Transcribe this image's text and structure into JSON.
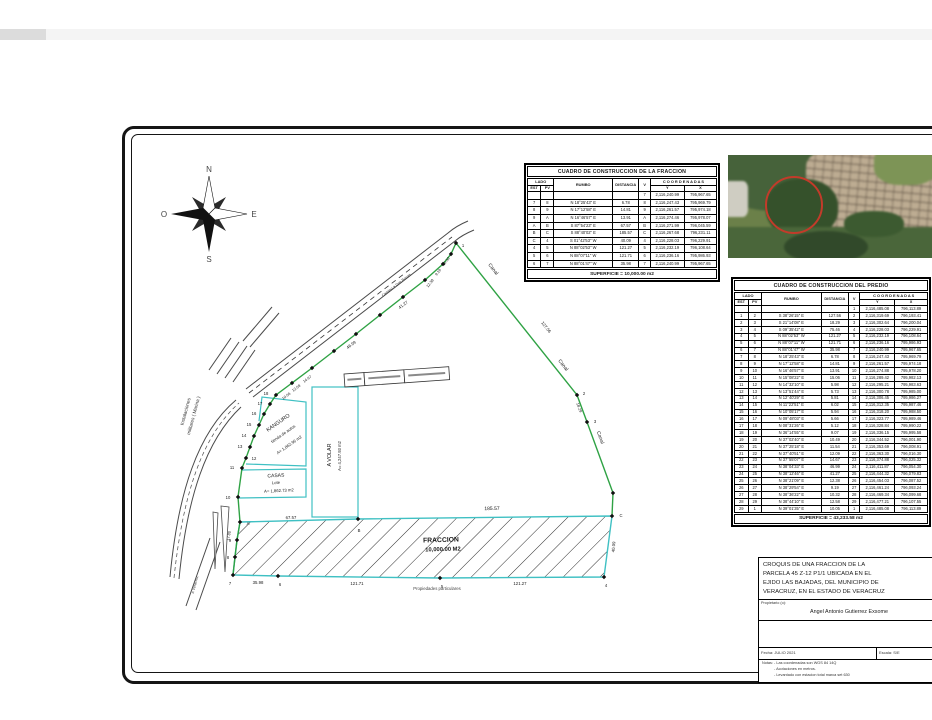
{
  "compass": {
    "n": "N",
    "s": "S",
    "e": "E",
    "o": "O"
  },
  "drawing": {
    "labels": [
      {
        "t": "Canal",
        "x": 492,
        "y": 270,
        "r": 52,
        "s": 5,
        "c": "#222",
        "n": "canal-label"
      },
      {
        "t": "Canal",
        "x": 562,
        "y": 366,
        "r": 52,
        "s": 5,
        "c": "#222",
        "n": "canal-label"
      },
      {
        "t": "Canal",
        "x": 599,
        "y": 438,
        "r": 70,
        "s": 5,
        "c": "#222",
        "n": "canal-label"
      },
      {
        "t": "127.56",
        "x": 545,
        "y": 328,
        "r": 52,
        "s": 4.3,
        "n": "distance-label"
      },
      {
        "t": "18.29",
        "x": 578,
        "y": 408,
        "r": 70,
        "s": 4,
        "n": "distance-label"
      },
      {
        "t": "41.27",
        "x": 404,
        "y": 306,
        "r": -37,
        "s": 4.3,
        "n": "distance-label"
      },
      {
        "t": "46.99",
        "x": 352,
        "y": 346,
        "r": -37,
        "s": 4.3,
        "n": "distance-label"
      },
      {
        "t": "14.67",
        "x": 308,
        "y": 380,
        "r": -37,
        "s": 3.8,
        "n": "distance-label"
      },
      {
        "t": "12.09",
        "x": 297,
        "y": 389,
        "r": -37,
        "s": 3.8,
        "n": "distance-label"
      },
      {
        "t": "10.06",
        "x": 287,
        "y": 397,
        "r": -37,
        "s": 3.8,
        "n": "distance-label"
      },
      {
        "t": "12.38",
        "x": 431,
        "y": 284,
        "r": -52,
        "s": 3.8,
        "n": "distance-label"
      },
      {
        "t": "9.19",
        "x": 439,
        "y": 273,
        "r": -52,
        "s": 3.8,
        "n": "distance-label"
      },
      {
        "t": "10.32",
        "x": 447,
        "y": 262,
        "r": -52,
        "s": 3.8,
        "n": "distance-label"
      },
      {
        "t": "185.57",
        "x": 492,
        "y": 510,
        "r": -1,
        "s": 5,
        "n": "distance-label"
      },
      {
        "t": "67.57",
        "x": 291,
        "y": 519,
        "r": -1,
        "s": 4.3,
        "n": "distance-label"
      },
      {
        "t": "35.98",
        "x": 258,
        "y": 584,
        "r": 0,
        "s": 4.3,
        "n": "distance-label"
      },
      {
        "t": "121.71",
        "x": 357,
        "y": 585,
        "r": 0,
        "s": 4.3,
        "n": "distance-label"
      },
      {
        "t": "121.27",
        "x": 520,
        "y": 585,
        "r": 0,
        "s": 4.3,
        "n": "distance-label"
      },
      {
        "t": "40.09",
        "x": 615,
        "y": 547,
        "r": -86,
        "s": 4.3,
        "n": "distance-label"
      },
      {
        "t": "17.80",
        "x": 230,
        "y": 536,
        "r": -80,
        "s": 3.8,
        "n": "distance-label"
      },
      {
        "t": "FRACCION",
        "x": 441,
        "y": 542,
        "r": -1.5,
        "s": 6.8,
        "b": true,
        "n": "area-label-fraccion"
      },
      {
        "t": "10,000.00 M2",
        "x": 443,
        "y": 551,
        "r": -1.5,
        "s": 5.8,
        "b": true,
        "n": "area-label-fraccion"
      },
      {
        "t": "Propiedades particulares",
        "x": 437,
        "y": 590,
        "r": 0,
        "s": 4.3,
        "c": "#444",
        "n": "neighbor-label"
      },
      {
        "t": "KANGURO",
        "x": 279,
        "y": 424,
        "r": -35,
        "s": 5.4,
        "n": "lot-label-kanguro"
      },
      {
        "t": "tienda de autos",
        "x": 284,
        "y": 435,
        "r": -35,
        "s": 4.2,
        "n": "lot-label-kanguro"
      },
      {
        "t": "A= 1,862.96 m2",
        "x": 290,
        "y": 446,
        "r": -35,
        "s": 4.2,
        "n": "lot-label-kanguro"
      },
      {
        "t": "A VOLAR",
        "x": 331,
        "y": 455,
        "r": -90,
        "s": 5.4,
        "n": "lot-label-avolar"
      },
      {
        "t": "A= 4,247.93 m2",
        "x": 341,
        "y": 456,
        "r": -90,
        "s": 4.2,
        "n": "lot-label-avolar"
      },
      {
        "t": "CASAS",
        "x": 276,
        "y": 477,
        "r": -3,
        "s": 5,
        "n": "lot-label-casas"
      },
      {
        "t": "Lote",
        "x": 276,
        "y": 484,
        "r": -3,
        "s": 4.2,
        "n": "lot-label-casas"
      },
      {
        "t": "A= 1,862.73 m2",
        "x": 279,
        "y": 492,
        "r": -3,
        "s": 4.2,
        "n": "lot-label-casas"
      },
      {
        "t": "Instalaciones",
        "x": 187,
        "y": 412,
        "r": -75,
        "s": 4.8,
        "c": "#333",
        "n": "military-label"
      },
      {
        "t": "militares ( Marina )",
        "x": 195,
        "y": 416,
        "r": -75,
        "s": 4.8,
        "c": "#333",
        "n": "military-label"
      },
      {
        "t": "Camino a Dos Bocas",
        "x": 397,
        "y": 286,
        "r": -37.5,
        "s": 3.8,
        "c": "#333",
        "n": "road-label"
      },
      {
        "t": "a Veracruz",
        "x": 196,
        "y": 585,
        "r": -75,
        "s": 3.8,
        "c": "#444",
        "n": "road-label"
      }
    ],
    "vertices": [
      {
        "x": 456,
        "y": 243,
        "l": "1",
        "dx": 7,
        "dy": 4
      },
      {
        "x": 577,
        "y": 395,
        "l": "2",
        "dx": 7,
        "dy": 0
      },
      {
        "x": 587,
        "y": 422,
        "l": "3",
        "dx": 8,
        "dy": 1
      },
      {
        "x": 613,
        "y": 493,
        "l": ""
      },
      {
        "x": 612,
        "y": 516,
        "l": "C",
        "dx": 9,
        "dy": 1
      },
      {
        "x": 604,
        "y": 577,
        "l": "4",
        "dx": 2,
        "dy": 10
      },
      {
        "x": 440,
        "y": 578,
        "l": "5",
        "dx": 2,
        "dy": 10
      },
      {
        "x": 278,
        "y": 576,
        "l": "6",
        "dx": 2,
        "dy": 10
      },
      {
        "x": 233,
        "y": 575,
        "l": "7",
        "dx": -3,
        "dy": 10
      },
      {
        "x": 235,
        "y": 557,
        "l": "8",
        "dx": -7,
        "dy": 2
      },
      {
        "x": 237,
        "y": 540,
        "l": "9",
        "dx": -7,
        "dy": 2
      },
      {
        "x": 240,
        "y": 522,
        "l": "A",
        "dx": 8,
        "dy": 3
      },
      {
        "x": 358,
        "y": 519,
        "l": "B",
        "dx": 1,
        "dy": 13
      },
      {
        "x": 238,
        "y": 497,
        "l": "10",
        "dx": -10,
        "dy": 2
      },
      {
        "x": 242,
        "y": 468,
        "l": "11",
        "dx": -10,
        "dy": 1
      },
      {
        "x": 246,
        "y": 458,
        "l": "12",
        "dx": 8,
        "dy": 2
      },
      {
        "x": 250,
        "y": 447,
        "l": "13",
        "dx": -10,
        "dy": 1
      },
      {
        "x": 254,
        "y": 436,
        "l": "14",
        "dx": -10,
        "dy": 1
      },
      {
        "x": 259,
        "y": 425,
        "l": "15",
        "dx": -10,
        "dy": 1
      },
      {
        "x": 264,
        "y": 414,
        "l": "16",
        "dx": -10,
        "dy": 1
      },
      {
        "x": 270,
        "y": 404,
        "l": "17",
        "dx": -10,
        "dy": 1
      },
      {
        "x": 276,
        "y": 395,
        "l": "18",
        "dx": -10,
        "dy": 0
      },
      {
        "x": 292,
        "y": 383,
        "l": ""
      },
      {
        "x": 312,
        "y": 368,
        "l": ""
      },
      {
        "x": 334,
        "y": 351,
        "l": ""
      },
      {
        "x": 356,
        "y": 334,
        "l": ""
      },
      {
        "x": 380,
        "y": 315,
        "l": ""
      },
      {
        "x": 403,
        "y": 297,
        "l": ""
      },
      {
        "x": 425,
        "y": 280,
        "l": ""
      },
      {
        "x": 443,
        "y": 264,
        "l": ""
      },
      {
        "x": 451,
        "y": 254,
        "l": ""
      }
    ]
  },
  "tables": {
    "fraccion": {
      "title": "CUADRO DE CONSTRUCCION DE LA FRACCION",
      "headers": {
        "lado": "LADO",
        "est": "EST",
        "pv": "PV",
        "rumbo": "RUMBO",
        "dist": "DISTANCIA",
        "v": "V",
        "coords": "C O O R D E N A D A S",
        "y": "Y",
        "x": "X"
      },
      "rows": [
        [
          "",
          "",
          "",
          "",
          "7",
          "2,116,240.99",
          "795,967.65"
        ],
        [
          "7",
          "8",
          "N 18°25'43\" E",
          "6.78",
          "8",
          "2,116,247.43",
          "795,969.79"
        ],
        [
          "8",
          "9",
          "N 17°12'58\" E",
          "14.81",
          "9",
          "2,116,261.57",
          "795,974.18"
        ],
        [
          "9",
          "A",
          "N 16°46'57\" E",
          "13.91",
          "A",
          "2,116,274.46",
          "795,978.07"
        ],
        [
          "A",
          "B",
          "S 87°54'23\" E",
          "67.57",
          "B",
          "2,116,271.99",
          "796,045.59"
        ],
        [
          "B",
          "C",
          "S 88°40'02\" E",
          "185.57",
          "C",
          "2,116,267.68",
          "796,231.11"
        ],
        [
          "C",
          "4",
          "S 01°42'53\" W",
          "40.09",
          "4",
          "2,116,228.03",
          "796,229.91"
        ],
        [
          "4",
          "5",
          "N 88°02'53\" W",
          "121.27",
          "5",
          "2,116,232.19",
          "796,108.64"
        ],
        [
          "5",
          "6",
          "N 88°07'11\" W",
          "121.71",
          "6",
          "2,116,236.16",
          "795,986.93"
        ],
        [
          "6",
          "7",
          "N 88°01'47\" W",
          "35.98",
          "7",
          "2,116,240.99",
          "795,967.65"
        ]
      ],
      "footer": "SUPERFICIE = 10,000.00 m2"
    },
    "predio": {
      "title": "CUADRO DE CONSTRUCCION DEL PREDIO",
      "headers": {
        "lado": "LADO",
        "est": "EST",
        "pv": "PV",
        "rumbo": "RUMBO",
        "dist": "DISTANCIA",
        "v": "V",
        "coords": "C O O R D E N A D A S",
        "y": "Y",
        "x": "X"
      },
      "rows": [
        [
          "",
          "",
          "",
          "",
          "1",
          "2,116,485.08",
          "796,113.89"
        ],
        [
          "1",
          "2",
          "S 38°26'15\" E",
          "127.56",
          "2",
          "2,116,319.69",
          "796,193.41"
        ],
        [
          "2",
          "3",
          "S 21°14'08\" E",
          "18.29",
          "3",
          "2,116,302.64",
          "796,200.04"
        ],
        [
          "3",
          "4",
          "S 09°35'42\" E",
          "75.46",
          "4",
          "2,116,228.03",
          "796,229.91"
        ],
        [
          "4",
          "5",
          "N 88°02'53\" W",
          "121.27",
          "5",
          "2,116,232.19",
          "796,108.64"
        ],
        [
          "5",
          "6",
          "N 88°07'11\" W",
          "121.71",
          "6",
          "2,116,236.16",
          "795,986.93"
        ],
        [
          "6",
          "7",
          "N 88°01'47\" W",
          "35.98",
          "7",
          "2,116,240.99",
          "795,967.65"
        ],
        [
          "7",
          "8",
          "N 18°25'43\" E",
          "6.78",
          "8",
          "2,116,247.43",
          "795,969.79"
        ],
        [
          "8",
          "9",
          "N 17°12'58\" E",
          "14.81",
          "9",
          "2,116,261.57",
          "795,974.18"
        ],
        [
          "9",
          "10",
          "N 16°46'57\" E",
          "13.91",
          "10",
          "2,116,274.88",
          "795,978.20"
        ],
        [
          "10",
          "11",
          "N 15°08'22\" E",
          "15.06",
          "11",
          "2,116,289.42",
          "795,982.13"
        ],
        [
          "11",
          "12",
          "N 14°32'10\" E",
          "5.98",
          "12",
          "2,116,295.21",
          "795,983.63"
        ],
        [
          "12",
          "13",
          "N 13°51'44\" E",
          "5.73",
          "13",
          "2,116,300.78",
          "795,985.00"
        ],
        [
          "13",
          "14",
          "N 12°40'29\" E",
          "5.81",
          "14",
          "2,116,306.45",
          "795,986.27"
        ],
        [
          "14",
          "15",
          "N 11°22'51\" E",
          "6.02",
          "15",
          "2,116,312.35",
          "795,987.46"
        ],
        [
          "15",
          "16",
          "N 10°05'17\" E",
          "5.94",
          "16",
          "2,116,318.20",
          "795,988.50"
        ],
        [
          "16",
          "17",
          "N 09°48'03\" E",
          "5.66",
          "17",
          "2,116,323.77",
          "795,989.46"
        ],
        [
          "17",
          "18",
          "N 08°31'26\" E",
          "5.12",
          "18",
          "2,116,328.84",
          "795,990.22"
        ],
        [
          "18",
          "19",
          "N 36°14'55\" E",
          "9.07",
          "19",
          "2,116,336.15",
          "795,995.58"
        ],
        [
          "19",
          "20",
          "N 37°02'40\" E",
          "10.49",
          "20",
          "2,116,344.52",
          "796,001.90"
        ],
        [
          "20",
          "21",
          "N 37°25'18\" E",
          "11.54",
          "21",
          "2,116,353.69",
          "796,008.91"
        ],
        [
          "21",
          "22",
          "N 37°40'51\" E",
          "12.09",
          "22",
          "2,116,363.30",
          "796,016.30"
        ],
        [
          "22",
          "23",
          "N 37°55'07\" E",
          "14.67",
          "23",
          "2,116,374.88",
          "796,025.32"
        ],
        [
          "23",
          "24",
          "N 38°04'33\" E",
          "46.99",
          "24",
          "2,116,411.87",
          "796,054.30"
        ],
        [
          "24",
          "25",
          "N 38°12'46\" E",
          "41.27",
          "25",
          "2,116,444.32",
          "796,079.83"
        ],
        [
          "25",
          "26",
          "N 38°21'09\" E",
          "12.38",
          "26",
          "2,116,454.03",
          "796,087.52"
        ],
        [
          "26",
          "27",
          "N 38°29'54\" E",
          "9.19",
          "27",
          "2,116,461.24",
          "796,093.24"
        ],
        [
          "27",
          "28",
          "N 38°36'22\" E",
          "10.32",
          "28",
          "2,116,469.34",
          "796,099.68"
        ],
        [
          "28",
          "29",
          "N 38°44'10\" E",
          "12.58",
          "29",
          "2,116,477.21",
          "796,107.55"
        ],
        [
          "29",
          "1",
          "N 39°01'35\" E",
          "10.05",
          "1",
          "2,116,485.08",
          "796,113.89"
        ]
      ],
      "footer": "SUPERFICIE = 43,233.58 m2"
    }
  },
  "titleblock": {
    "title_lines": [
      "CROQUIS DE UNA FRACCION DE  LA",
      "PARCELA 45 Z-12 P1/1 UBICADA EN EL",
      "EJIDO LAS BAJADAS,  DEL MUNICIPIO DE",
      "VERACRUZ,  EN EL ESTADO DE VERACRUZ"
    ],
    "owner_label": "Propietario (o):",
    "owner_name": "Angel Antonio Gutierrez Exsome",
    "fecha_label": "Fecha:",
    "fecha_value": "JULIO 2021",
    "escala_label": "Escala:",
    "escala_value": "S/E",
    "notas_label": "Notas:",
    "notas": [
      "- Las coordenadas son WGS 84 14Q",
      "- Acotaciones en metros.",
      "- Levantado con estacion total marca set 630"
    ]
  }
}
